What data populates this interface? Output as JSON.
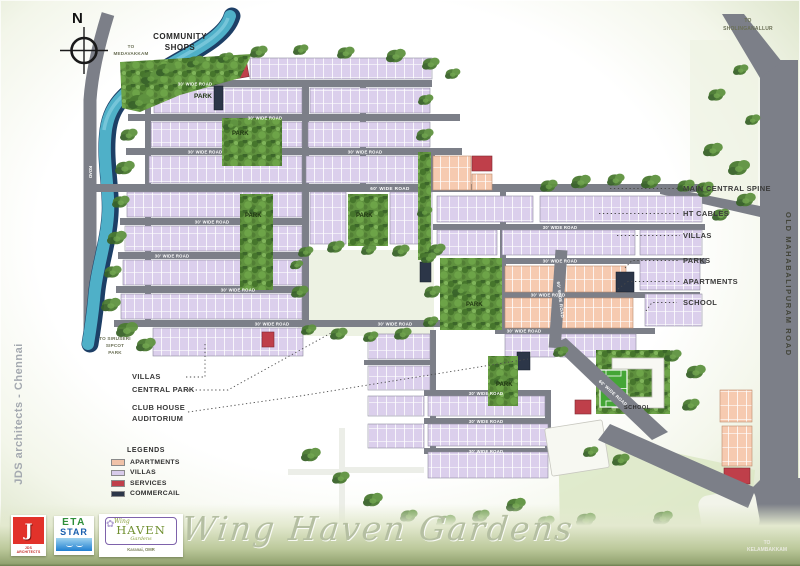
{
  "compass": {
    "north": "N"
  },
  "labels": {
    "community_shops": "COMMUNITY\nSHOPS",
    "to_top_left": "TO\nMEDAVAKKAM",
    "to_top_right": "TO\nSHOLINGANALLUR",
    "to_bottom_right": "TO\nKELAMBAKKAM",
    "to_left": "TO SIRUSERI\nSIPCOT\nPARK",
    "park": "PARK",
    "school": "SCHOOL",
    "omr": "OLD MAHABALIPURAM ROAD",
    "road_30": "30' WIDE ROAD",
    "road_60": "60' WIDE ROAD",
    "road": "ROAD"
  },
  "callouts": {
    "right": [
      "MAIN CENTRAL SPINE",
      "HT CABLES",
      "VILLAS",
      "PARKS",
      "APARTMENTS",
      "SCHOOL"
    ],
    "left": [
      "VILLAS",
      "CENTRAL PARK",
      "CLUB HOUSE\nAUDITORIUM"
    ]
  },
  "legend": {
    "header": "LEGENDS",
    "items": [
      {
        "label": "APARTMENTS",
        "color": "#f0c2a8"
      },
      {
        "label": "VILLAS",
        "color": "#d8cbea"
      },
      {
        "label": "SERVICES",
        "color": "#bf3f4a"
      },
      {
        "label": "COMMERCAIL",
        "color": "#2c3648"
      }
    ]
  },
  "branding": {
    "side_text": "JDS architects - Chennai",
    "title_script": "Wing Haven Gardens",
    "logos": {
      "jds": {
        "monogram": "J",
        "caption": "JDS ARCHITECTS"
      },
      "eta": {
        "line1": "ETA",
        "line2": "STAR"
      },
      "haven": {
        "pre": "Wing",
        "name": "HAVEN",
        "post": "Gardens",
        "caption": "Karanai, OMR"
      }
    },
    "icons": {
      "flourish": "✿"
    }
  },
  "colors": {
    "villas": "#dbcfec",
    "apartments": "#f6cab0",
    "services": "#bf3f4a",
    "commercial": "#2c3648",
    "road": "#7c7f88",
    "canal": "#4fb0c8",
    "park": "#5f913e"
  }
}
